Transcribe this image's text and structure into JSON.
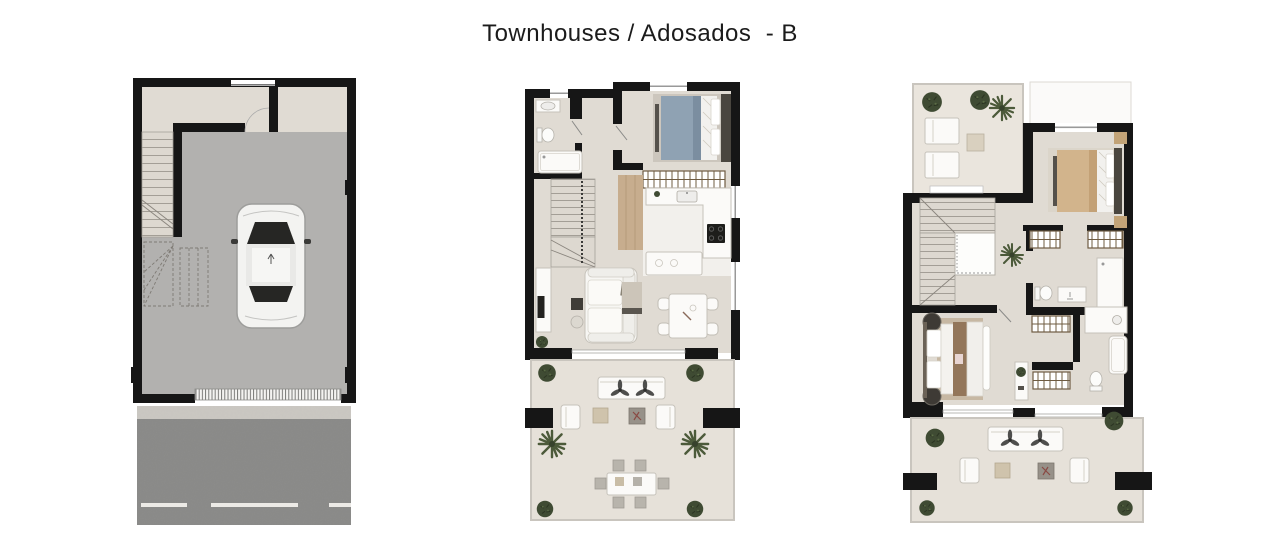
{
  "header": {
    "title": "Townhouses / Adosados  - B"
  },
  "colors": {
    "wall": "#161616",
    "floor_beige": "#e0dbd3",
    "floor_terrace": "#e6e1d9",
    "floor_garage": "#b2b1af",
    "road_asphalt": "#8d8d8b",
    "sidewalk": "#cbc8c2",
    "wood": "#c7ad8e",
    "bed_blue": "#8fa2b3",
    "bed_tan": "#d2b48c",
    "duvet_brown": "#93765a",
    "plant_dark": "#3f4b33",
    "closet_brown": "#6f5c42",
    "furniture_white": "#fbfaf8",
    "headboard_dark": "#4a463f"
  },
  "plans": [
    {
      "id": "basement-garage"
    },
    {
      "id": "ground-floor"
    },
    {
      "id": "first-floor"
    }
  ]
}
